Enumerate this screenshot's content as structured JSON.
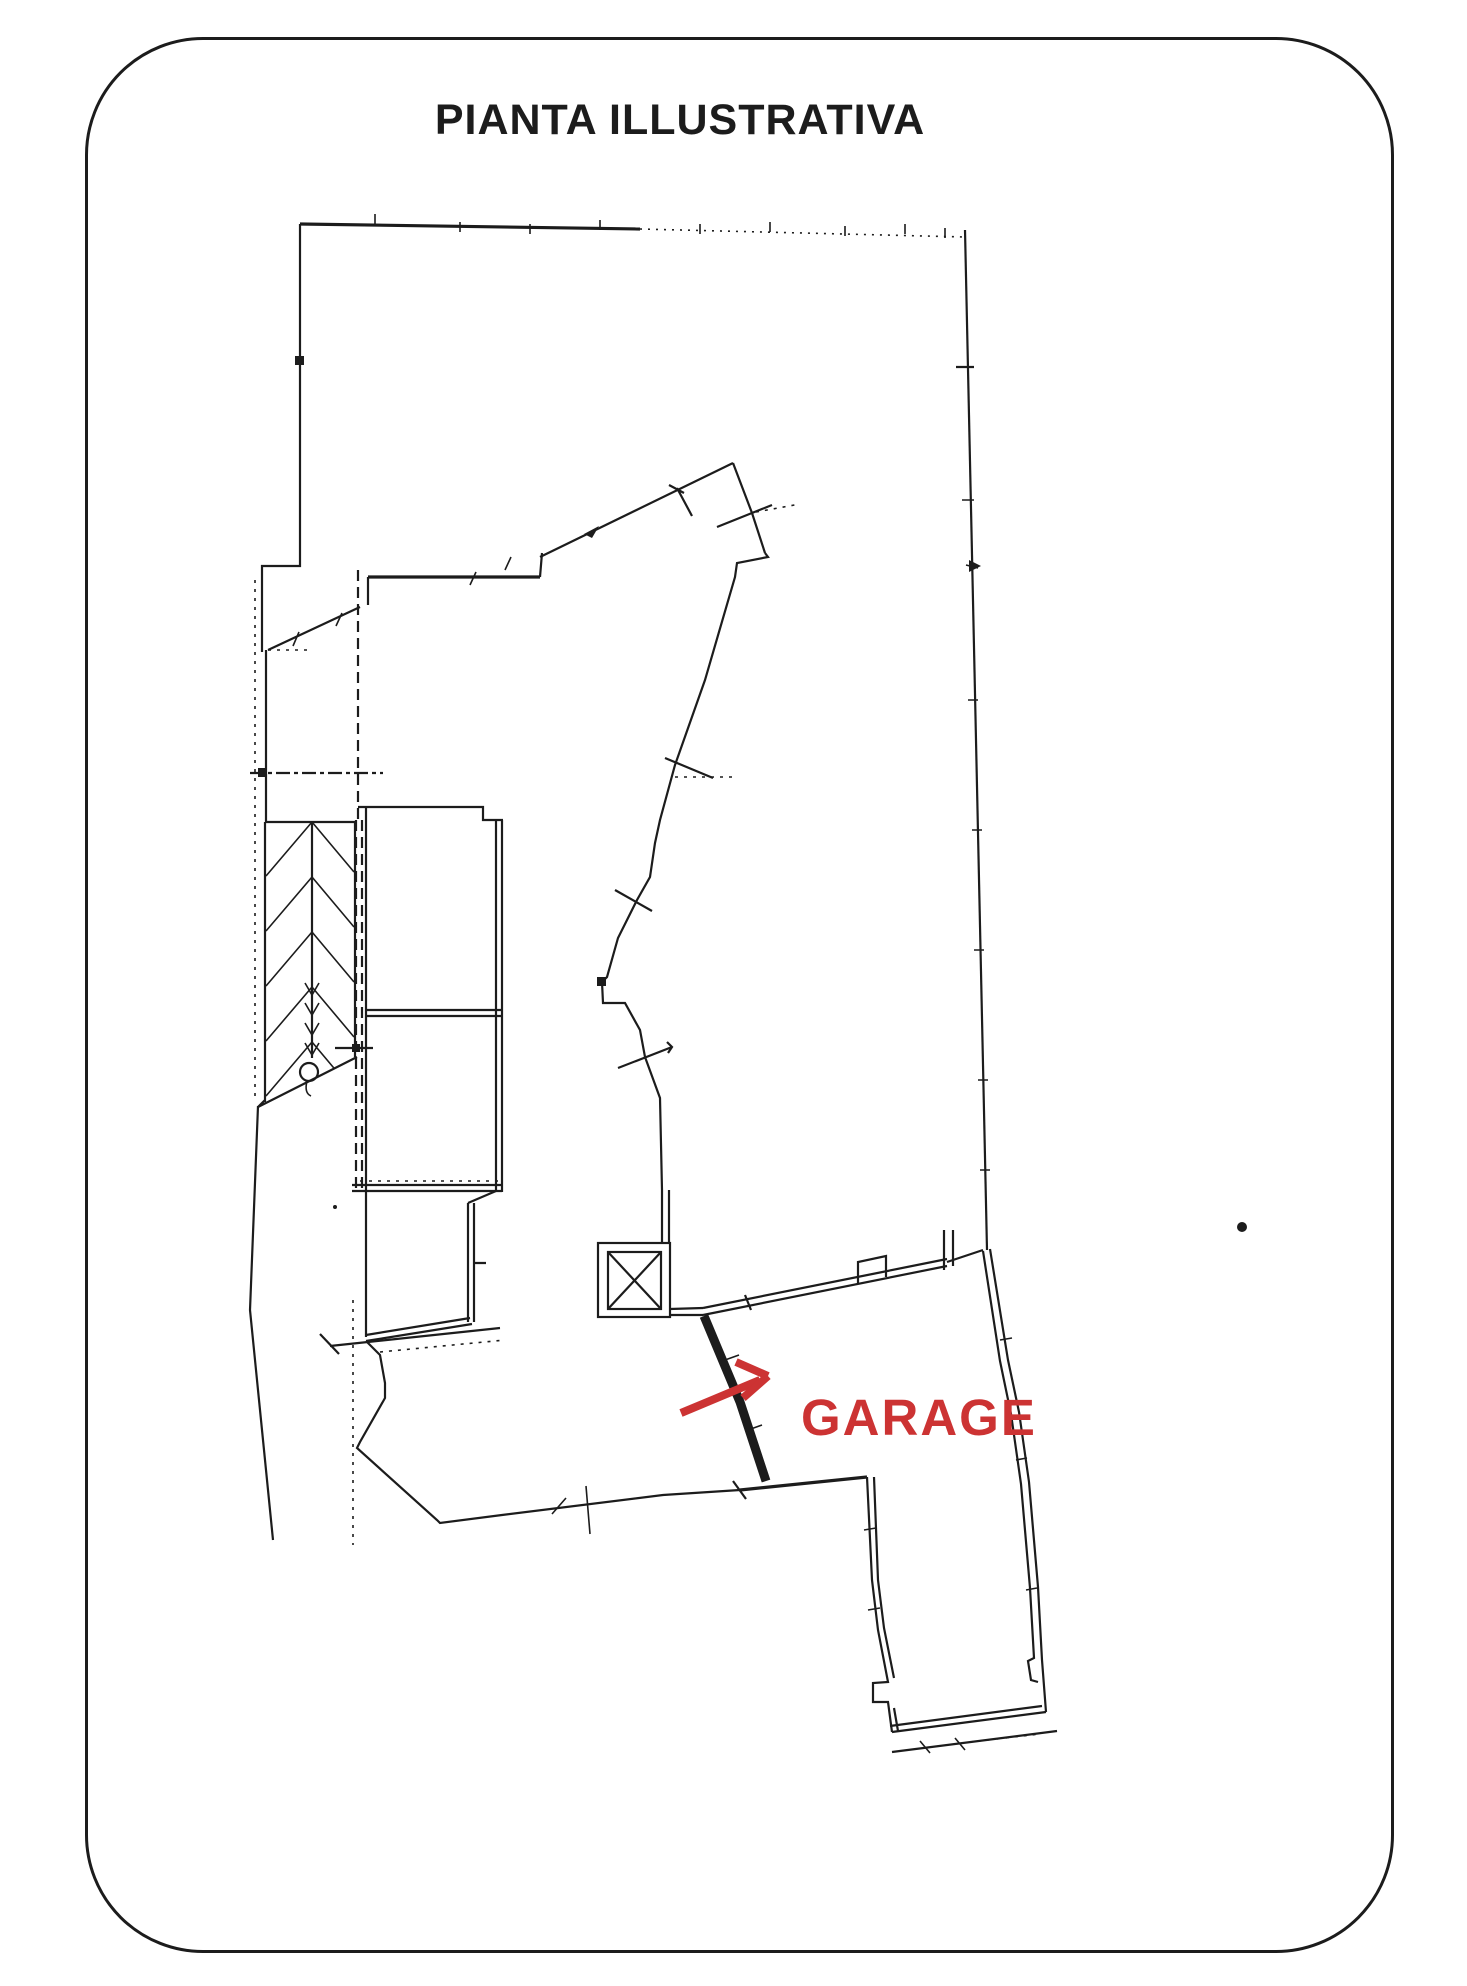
{
  "page": {
    "title": "PIANTA ILLUSTRATIVA"
  },
  "plan": {
    "garage_label": "GARAGE"
  },
  "colors": {
    "ink": "#1c1c1c",
    "accent_red": "#cc3333",
    "paper": "#ffffff"
  }
}
